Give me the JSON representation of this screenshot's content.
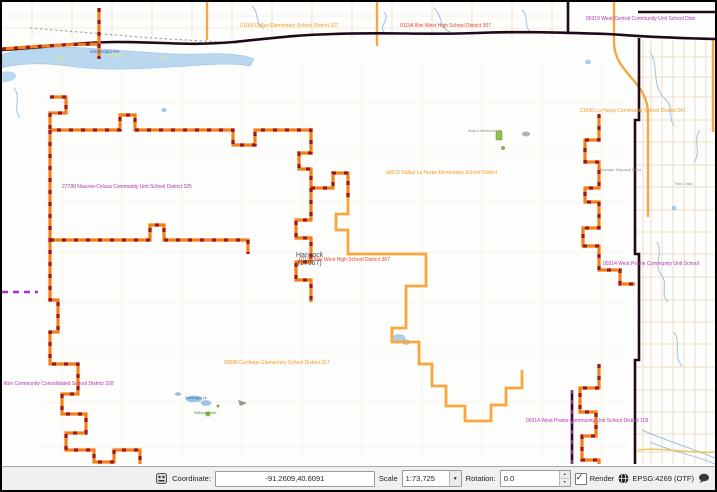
{
  "app": "QGIS map canvas",
  "map": {
    "labels": {
      "mississippi_river": "Mississippi Riv",
      "dallas_elementary_top": "01160 Dallas Elementary School District 327",
      "illini_west_top": "01194 Illini West High School District 307",
      "west_central": "00319 West Central Community Unit School Distr",
      "la_harpe": "21690 La Harpe Community School District 347",
      "nauvoo_colusa": "27780 Nauvoo-Colusa Community Unit School District 325",
      "dallas_la_harpe": "a0670 Dallas La Harpe Elementary School District",
      "hancock_name": "Hancock",
      "hancock_fips": "(17067)",
      "illini_west_center": "01194 Illini West High School District 307",
      "west_prairie_right": "00314 West Prairie Community Unit School",
      "carthage_elementary": "09680 Carthage Elementary School District 317",
      "hamilton": "ilton Community Consolidated School District 328",
      "west_prairie_bottom": "00314 West Prairie Community Unit School District 103",
      "mayor_memorial_park": "Mayor Memorial Pk",
      "carthage_lake": "Carthage Lk",
      "wildcat_park": "Wildcat Park",
      "sewage_disposal": "Sewage Disposal Pond",
      "twin_oaks": "Twin Oaks"
    },
    "colors": {
      "district_dashed_base": "#f08019",
      "district_dashed_overlay": "#a01616",
      "elementary_boundary": "#f9a63c",
      "county_line": "#200a1a",
      "purple_boundary": "#a82cd0",
      "river_fill": "#b9d7ef",
      "road_grid": "#e9dfc9"
    }
  },
  "status_bar": {
    "coordinate_label": "Coordinate:",
    "coordinate_value": "-91.2609,40.6091",
    "scale_label": "Scale",
    "scale_value": "1:73,725",
    "rotation_label": "Rotation:",
    "rotation_value": "0.0",
    "render_label": "Render",
    "epsg_label": "EPSG:4269 (OTF)"
  }
}
